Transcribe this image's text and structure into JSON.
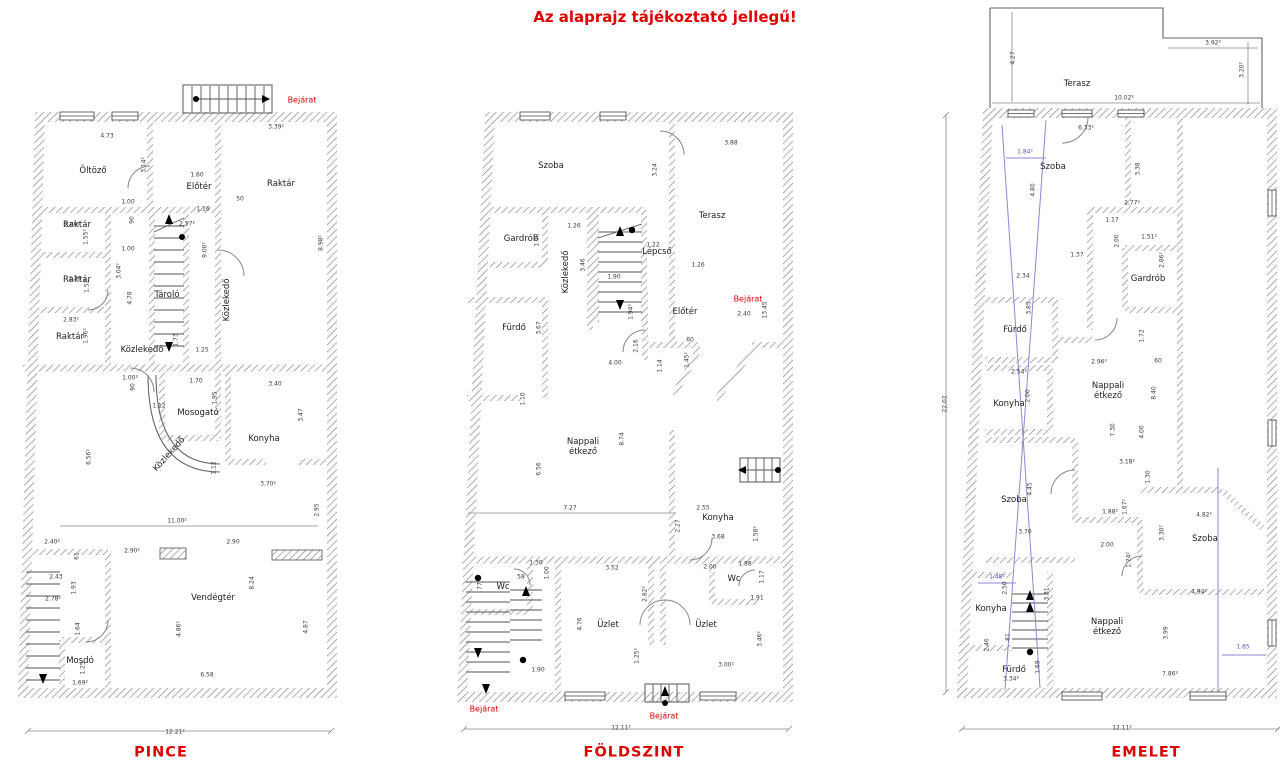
{
  "title": "Az alaprajz tájékoztató jellegű!",
  "colors": {
    "accent_red": "#dd0000",
    "section_blue": "#5a5ac0",
    "wall_hatch": "#777777"
  },
  "plans": [
    {
      "id": "pince",
      "name": "PINCE",
      "overall_width": "12.21²",
      "labels": [
        [
          "Öltöző",
          93,
          172,
          "r",
          0
        ],
        [
          "Előtér",
          199,
          188,
          "r",
          0
        ],
        [
          "Raktár",
          281,
          185,
          "r",
          0
        ],
        [
          "Raktár",
          77,
          226,
          "r",
          0
        ],
        [
          "Raktár",
          77,
          281,
          "r",
          0
        ],
        [
          "Raktár",
          70,
          338,
          "r",
          0
        ],
        [
          "Tároló",
          167,
          296,
          "r",
          0
        ],
        [
          "Közlekedő",
          228,
          300,
          "r",
          -90
        ],
        [
          "Közlekedő",
          142,
          351,
          "r",
          0
        ],
        [
          "Mosogató",
          198,
          414,
          "r",
          0
        ],
        [
          "Konyha",
          264,
          440,
          "r",
          0
        ],
        [
          "Közlekedő",
          170,
          455,
          "r",
          -48
        ],
        [
          "Vendégtér",
          213,
          599,
          "r",
          0
        ],
        [
          "Mosdó",
          80,
          662,
          "r",
          0
        ],
        [
          "Bejárat",
          302,
          100,
          "red",
          0
        ],
        [
          "PINCE",
          161,
          753,
          "plan",
          0
        ],
        [
          "4.73",
          107,
          137,
          "d",
          0
        ],
        [
          "3.39²",
          276,
          128,
          "d",
          0
        ],
        [
          "3.14²",
          145,
          165,
          "d",
          -90
        ],
        [
          "1.60",
          197,
          176,
          "d",
          0
        ],
        [
          "1.00",
          128,
          203,
          "d",
          0
        ],
        [
          "90",
          133,
          220,
          "d",
          -90
        ],
        [
          "1.16",
          203,
          210,
          "d",
          0
        ],
        [
          "50",
          240,
          200,
          "d",
          0
        ],
        [
          "2.69²",
          72,
          226,
          "d",
          0
        ],
        [
          "1.55²",
          87,
          237,
          "d",
          -90
        ],
        [
          "2.57²",
          187,
          225,
          "d",
          0
        ],
        [
          "9.00²",
          206,
          250,
          "d",
          -90
        ],
        [
          "8.98²",
          322,
          243,
          "d",
          -90
        ],
        [
          "1.00",
          128,
          250,
          "d",
          0
        ],
        [
          "2.70",
          75,
          280,
          "d",
          0
        ],
        [
          "1.52²",
          88,
          285,
          "d",
          -90
        ],
        [
          "3.04²",
          120,
          271,
          "d",
          -90
        ],
        [
          "4.78",
          131,
          298,
          "d",
          -90
        ],
        [
          "2.83²",
          71,
          321,
          "d",
          0
        ],
        [
          "1.96²",
          87,
          336,
          "d",
          -90
        ],
        [
          "1.73",
          177,
          340,
          "d",
          -90
        ],
        [
          "1.25",
          202,
          351,
          "d",
          0
        ],
        [
          "1.00²",
          130,
          379,
          "d",
          0
        ],
        [
          "90",
          134,
          387,
          "d",
          -90
        ],
        [
          "1.70",
          196,
          382,
          "d",
          0
        ],
        [
          "1.95",
          216,
          398,
          "d",
          -90
        ],
        [
          "3.40",
          275,
          385,
          "d",
          0
        ],
        [
          "3.47",
          302,
          415,
          "d",
          -90
        ],
        [
          "1.12",
          159,
          407,
          "d",
          0
        ],
        [
          "1.12",
          215,
          468,
          "d",
          -90
        ],
        [
          "6.56²",
          90,
          457,
          "d",
          -90
        ],
        [
          "3.70²",
          268,
          485,
          "d",
          0
        ],
        [
          "2.95",
          318,
          510,
          "d",
          -90
        ],
        [
          "11.00²",
          177,
          522,
          "d",
          0
        ],
        [
          "2.40²",
          52,
          543,
          "d",
          0
        ],
        [
          "61",
          78,
          556,
          "d",
          -90
        ],
        [
          "2.90²",
          132,
          552,
          "d",
          0
        ],
        [
          "2.90",
          233,
          543,
          "d",
          0
        ],
        [
          "2.43",
          56,
          578,
          "d",
          0
        ],
        [
          "1.93",
          75,
          588,
          "d",
          -90
        ],
        [
          "2.78²",
          53,
          600,
          "d",
          0
        ],
        [
          "8.24",
          253,
          583,
          "d",
          -90
        ],
        [
          "1.64",
          79,
          629,
          "d",
          -90
        ],
        [
          "4.86²",
          180,
          629,
          "d",
          -90
        ],
        [
          "4.87",
          307,
          627,
          "d",
          -90
        ],
        [
          "1.25",
          84,
          668,
          "d",
          -90
        ],
        [
          "1.69²",
          80,
          684,
          "d",
          0
        ],
        [
          "6.58",
          207,
          676,
          "d",
          0
        ],
        [
          "12.21²",
          175,
          733,
          "d",
          0
        ]
      ]
    },
    {
      "id": "foldszint",
      "name": "FÖLDSZINT",
      "overall_width": "12.11²",
      "labels": [
        [
          "Szoba",
          551,
          167,
          "r",
          0
        ],
        [
          "Gardrób",
          521,
          240,
          "r",
          0
        ],
        [
          "Közlekedő",
          567,
          272,
          "r",
          -90
        ],
        [
          "Lépcső",
          657,
          253,
          "r",
          0
        ],
        [
          "Terasz",
          712,
          217,
          "r",
          0
        ],
        [
          "Előtér",
          685,
          313,
          "r",
          0
        ],
        [
          "Fürdő",
          514,
          329,
          "r",
          0
        ],
        [
          "Nappali\nétkező",
          583,
          448,
          "r",
          0
        ],
        [
          "Konyha",
          718,
          519,
          "r",
          0
        ],
        [
          "Wc",
          503,
          588,
          "r",
          0
        ],
        [
          "Üzlet",
          608,
          626,
          "r",
          0
        ],
        [
          "Üzlet",
          706,
          626,
          "r",
          0
        ],
        [
          "Wc",
          734,
          580,
          "r",
          0
        ],
        [
          "Bejárat",
          748,
          299,
          "red",
          0
        ],
        [
          "Bejárat",
          484,
          709,
          "red",
          0
        ],
        [
          "Bejárat",
          664,
          716,
          "red",
          0
        ],
        [
          "FÖLDSZINT",
          634,
          753,
          "plan",
          0
        ],
        [
          "3.88",
          731,
          144,
          "d",
          0
        ],
        [
          "3.24",
          656,
          170,
          "d",
          -90
        ],
        [
          "1.26",
          574,
          227,
          "d",
          0
        ],
        [
          "1.38",
          538,
          240,
          "d",
          -90
        ],
        [
          "3.46",
          584,
          265,
          "d",
          -90
        ],
        [
          "1.22",
          653,
          246,
          "d",
          0
        ],
        [
          "1.90",
          614,
          278,
          "d",
          0
        ],
        [
          "1.26",
          698,
          266,
          "d",
          0
        ],
        [
          "2.40",
          744,
          315,
          "d",
          0
        ],
        [
          "13.45",
          766,
          310,
          "d",
          -90
        ],
        [
          "1.94²",
          632,
          312,
          "d",
          -90
        ],
        [
          "3.67",
          540,
          328,
          "d",
          -90
        ],
        [
          "2.16",
          637,
          346,
          "d",
          -90
        ],
        [
          "4.00",
          615,
          364,
          "d",
          0
        ],
        [
          "1.14",
          661,
          366,
          "d",
          -90
        ],
        [
          "1.45²",
          688,
          360,
          "d",
          -90
        ],
        [
          "60",
          690,
          341,
          "d",
          0
        ],
        [
          "1.10",
          524,
          399,
          "d",
          -90
        ],
        [
          "8.74",
          623,
          439,
          "d",
          -90
        ],
        [
          "6.56",
          540,
          469,
          "d",
          -90
        ],
        [
          "7.27",
          570,
          509,
          "d",
          0
        ],
        [
          "2.55",
          703,
          509,
          "d",
          0
        ],
        [
          "2.27",
          679,
          526,
          "d",
          -90
        ],
        [
          "3.68",
          718,
          538,
          "d",
          0
        ],
        [
          "1.58²",
          757,
          534,
          "d",
          -90
        ],
        [
          "1.30",
          536,
          564,
          "d",
          0
        ],
        [
          "1.00",
          548,
          573,
          "d",
          -90
        ],
        [
          "58",
          521,
          578,
          "d",
          0
        ],
        [
          "77",
          481,
          586,
          "d",
          -90
        ],
        [
          "3.52",
          612,
          569,
          "d",
          0
        ],
        [
          "2.00",
          710,
          568,
          "d",
          0
        ],
        [
          "1.88",
          745,
          565,
          "d",
          0
        ],
        [
          "1.17",
          763,
          577,
          "d",
          -90
        ],
        [
          "1.91",
          757,
          599,
          "d",
          0
        ],
        [
          "2.82²",
          646,
          594,
          "d",
          -90
        ],
        [
          "4.76",
          581,
          624,
          "d",
          -90
        ],
        [
          "3.46²",
          761,
          639,
          "d",
          -90
        ],
        [
          "1.25²",
          638,
          656,
          "d",
          -90
        ],
        [
          "3.00²",
          726,
          666,
          "d",
          0
        ],
        [
          "1.90",
          538,
          671,
          "d",
          0
        ],
        [
          "12.11²",
          621,
          729,
          "d",
          0
        ]
      ]
    },
    {
      "id": "emelet",
      "name": "EMELET",
      "overall_width": "12.11²",
      "overall_height": "22.02",
      "labels": [
        [
          "Terasz",
          1077,
          85,
          "r",
          0
        ],
        [
          "Szoba",
          1053,
          168,
          "r",
          0
        ],
        [
          "Gardrób",
          1148,
          280,
          "r",
          0
        ],
        [
          "Fürdő",
          1015,
          331,
          "r",
          0
        ],
        [
          "Konyha",
          1009,
          405,
          "r",
          0
        ],
        [
          "Nappali\nétkező",
          1108,
          392,
          "r",
          0
        ],
        [
          "Szoba",
          1014,
          501,
          "r",
          0
        ],
        [
          "Szoba",
          1205,
          540,
          "r",
          0
        ],
        [
          "Konyha",
          991,
          610,
          "r",
          0
        ],
        [
          "Fürdő",
          1014,
          671,
          "r",
          0
        ],
        [
          "Nappali\nétkező",
          1107,
          628,
          "r",
          0
        ],
        [
          "EMELET",
          1146,
          753,
          "plan",
          0
        ],
        [
          "4.27",
          1014,
          58,
          "d",
          -90
        ],
        [
          "3.92²",
          1213,
          44,
          "d",
          0
        ],
        [
          "3.20²",
          1243,
          70,
          "d",
          -90
        ],
        [
          "10.02²",
          1124,
          99,
          "d",
          0
        ],
        [
          "6.33²",
          1086,
          129,
          "d",
          0
        ],
        [
          "3.38",
          1139,
          169,
          "d",
          -90
        ],
        [
          "4.80",
          1034,
          190,
          "d",
          -90
        ],
        [
          "2.77²",
          1132,
          204,
          "d",
          0
        ],
        [
          "1.17",
          1112,
          221,
          "d",
          0
        ],
        [
          "2.00",
          1118,
          241,
          "d",
          -90
        ],
        [
          "1.51²",
          1149,
          238,
          "d",
          0
        ],
        [
          "2.86²",
          1163,
          260,
          "d",
          -90
        ],
        [
          "1.37",
          1077,
          256,
          "d",
          0
        ],
        [
          "2.34",
          1023,
          277,
          "d",
          0
        ],
        [
          "3.85",
          1030,
          308,
          "d",
          -90
        ],
        [
          "1.72",
          1143,
          336,
          "d",
          -90
        ],
        [
          "2.96²",
          1099,
          363,
          "d",
          0
        ],
        [
          "60",
          1158,
          362,
          "d",
          0
        ],
        [
          "2.54²",
          1019,
          373,
          "d",
          0
        ],
        [
          "2.00",
          1029,
          396,
          "d",
          -90
        ],
        [
          "8.40",
          1155,
          393,
          "d",
          -90
        ],
        [
          "7.30",
          1114,
          430,
          "d",
          -90
        ],
        [
          "4.00",
          1143,
          432,
          "d",
          -90
        ],
        [
          "3.18²",
          1127,
          463,
          "d",
          0
        ],
        [
          "1.30",
          1149,
          477,
          "d",
          -90
        ],
        [
          "4.45",
          1031,
          489,
          "d",
          -90
        ],
        [
          "1.88²",
          1110,
          513,
          "d",
          0
        ],
        [
          "1.67²",
          1126,
          507,
          "d",
          -90
        ],
        [
          "4.82²",
          1204,
          516,
          "d",
          0
        ],
        [
          "3.30²",
          1163,
          533,
          "d",
          -90
        ],
        [
          "3.70",
          1025,
          533,
          "d",
          0
        ],
        [
          "2.00",
          1107,
          546,
          "d",
          0
        ],
        [
          "1.74²",
          1130,
          560,
          "d",
          -90
        ],
        [
          "4.94²",
          1199,
          593,
          "d",
          0
        ],
        [
          "2.50",
          1006,
          588,
          "d",
          -90
        ],
        [
          "2.46",
          988,
          645,
          "d",
          -90
        ],
        [
          "81",
          1009,
          637,
          "d",
          -90
        ],
        [
          "3.31",
          1048,
          594,
          "d",
          -90
        ],
        [
          "3.99",
          1167,
          633,
          "d",
          -90
        ],
        [
          "1.69",
          1039,
          667,
          "d",
          -90
        ],
        [
          "3.34²",
          1011,
          680,
          "d",
          0
        ],
        [
          "7.86²",
          1170,
          675,
          "d",
          0
        ],
        [
          "22.02",
          946,
          404,
          "d",
          -90
        ],
        [
          "12.11²",
          1122,
          729,
          "d",
          0
        ],
        [
          "1.84²",
          1025,
          153,
          "b",
          0
        ],
        [
          "1.48²",
          997,
          578,
          "b",
          0
        ],
        [
          "1.85",
          1243,
          648,
          "b",
          0
        ]
      ]
    }
  ]
}
